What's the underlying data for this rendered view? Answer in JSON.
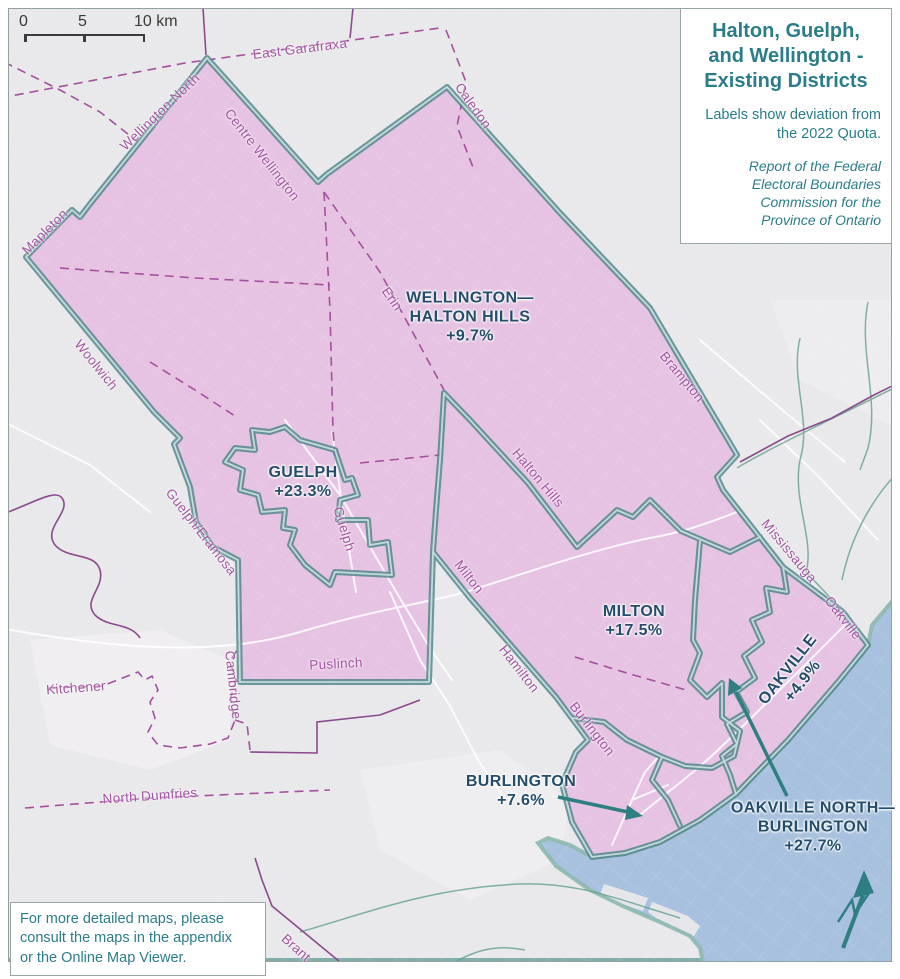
{
  "title_box": {
    "title_lines": [
      "Halton, Guelph,",
      "and Wellington -",
      "Existing Districts"
    ],
    "subtitle_lines": [
      "Labels show deviation from",
      "the 2022 Quota."
    ],
    "attribution_lines": [
      "Report of the Federal",
      "Electoral Boundaries",
      "Commission for the",
      "Province of Ontario"
    ]
  },
  "scale_bar": {
    "labels": [
      "0",
      "5",
      "10 km"
    ],
    "unit": "km"
  },
  "note_box": {
    "lines": [
      "For more detailed maps, please",
      "consult the maps in the appendix",
      "or the Online Map Viewer."
    ]
  },
  "districts": [
    {
      "id": "wellington-halton-hills",
      "lines": [
        "WELLINGTON—",
        "HALTON HILLS",
        "+9.7%"
      ],
      "deviation": "+9.7%",
      "x": 470,
      "y": 318,
      "rot": 0
    },
    {
      "id": "guelph",
      "lines": [
        "GUELPH",
        "+23.3%"
      ],
      "deviation": "+23.3%",
      "x": 303,
      "y": 483,
      "rot": 0
    },
    {
      "id": "milton",
      "lines": [
        "MILTON",
        "+17.5%"
      ],
      "deviation": "+17.5%",
      "x": 634,
      "y": 622,
      "rot": 0
    },
    {
      "id": "oakville",
      "lines": [
        "OAKVILLE",
        "+4.9%"
      ],
      "deviation": "+4.9%",
      "x": 796,
      "y": 676,
      "rot": -52
    },
    {
      "id": "burlington",
      "lines": [
        "BURLINGTON",
        "+7.6%"
      ],
      "deviation": "+7.6%",
      "x": 521,
      "y": 792,
      "rot": 0
    },
    {
      "id": "oakville-north-burlington",
      "lines": [
        "OAKVILLE NORTH—",
        "BURLINGTON",
        "+27.7%"
      ],
      "deviation": "+27.7%",
      "x": 813,
      "y": 828,
      "rot": 0
    }
  ],
  "municipalities": [
    {
      "name": "East Garafraxa",
      "x": 300,
      "y": 49,
      "rot": -7
    },
    {
      "name": "Caledon",
      "x": 473,
      "y": 106,
      "rot": 55
    },
    {
      "name": "Wellington North",
      "x": 160,
      "y": 112,
      "rot": -44
    },
    {
      "name": "Centre Wellington",
      "x": 262,
      "y": 155,
      "rot": 52
    },
    {
      "name": "Mapleton",
      "x": 45,
      "y": 232,
      "rot": -45
    },
    {
      "name": "Erin",
      "x": 392,
      "y": 299,
      "rot": 55
    },
    {
      "name": "Woolwich",
      "x": 96,
      "y": 365,
      "rot": 51
    },
    {
      "name": "Guelph/Eramosa",
      "x": 201,
      "y": 532,
      "rot": 52
    },
    {
      "name": "Guelph",
      "x": 344,
      "y": 529,
      "rot": 73
    },
    {
      "name": "Halton Hills",
      "x": 538,
      "y": 478,
      "rot": 50
    },
    {
      "name": "Milton",
      "x": 469,
      "y": 577,
      "rot": 52
    },
    {
      "name": "Brampton",
      "x": 682,
      "y": 377,
      "rot": 50
    },
    {
      "name": "Mississauga",
      "x": 789,
      "y": 551,
      "rot": 50
    },
    {
      "name": "Oakville",
      "x": 843,
      "y": 618,
      "rot": 52
    },
    {
      "name": "Hamilton",
      "x": 519,
      "y": 669,
      "rot": 52
    },
    {
      "name": "Burlington",
      "x": 592,
      "y": 729,
      "rot": 52
    },
    {
      "name": "Kitchener",
      "x": 76,
      "y": 688,
      "rot": -4
    },
    {
      "name": "Cambridge",
      "x": 233,
      "y": 685,
      "rot": 84
    },
    {
      "name": "Puslinch",
      "x": 336,
      "y": 664,
      "rot": -3
    },
    {
      "name": "North Dumfries",
      "x": 150,
      "y": 796,
      "rot": -4
    },
    {
      "name": "Brant",
      "x": 296,
      "y": 948,
      "rot": 42
    }
  ],
  "colors": {
    "district_fill": "#e6c3e2",
    "district_boundary": "#4f878a",
    "water": "#a8c1de",
    "coastline": "#8cb8ae",
    "municipal_purple": "#a4509e",
    "district_label": "#244d6b",
    "panel_text_teal": "#2a7d89",
    "land_gray": "#e9e8ea"
  }
}
